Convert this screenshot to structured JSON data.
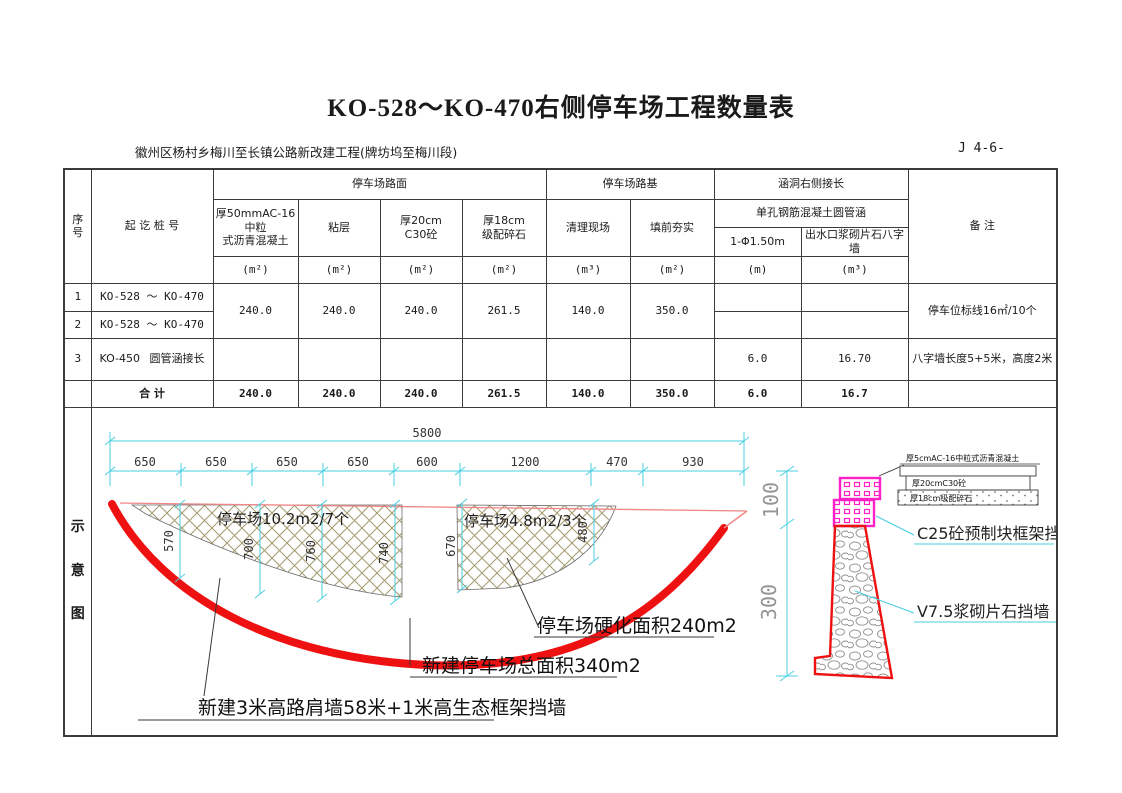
{
  "title": "KO-528～KO-470右侧停车场工程数量表",
  "subtitle": "徽州区杨村乡梅川至长镇公路新改建工程(牌坊坞至梅川段)",
  "sheet_no": "J 4-6-",
  "table": {
    "h_seq": "序号",
    "h_stake": "起    讫    桩    号",
    "h_pavement_group": "停车场路面",
    "h_roadbed_group": "停车场路基",
    "h_culvert_group": "涵洞右侧接长",
    "h_culvert_sub": "单孔钢筋混凝土圆管涵",
    "h_remark": "备    注",
    "h_c1": "厚50mmAC-16中粒\n式沥青混凝土",
    "h_c2": "粘层",
    "h_c3": "厚20cm\nC30砼",
    "h_c4": "厚18cm\n级配碎石",
    "h_c5": "清理现场",
    "h_c6": "填前夯实",
    "h_c7": "1-Φ1.50m",
    "h_c8": "出水口浆砌片石八字墙",
    "u_c1": "(m²)",
    "u_c2": "(m²)",
    "u_c3": "(m²)",
    "u_c4": "(m²)",
    "u_c5": "(m³)",
    "u_c6": "(m²)",
    "u_c7": "(m)",
    "u_c8": "(m³)",
    "rows": {
      "r1_seq": "1",
      "r1_stake": "KO-528    ～    KO-470",
      "r2_seq": "2",
      "r2_stake": "KO-528    ～    KO-470",
      "r3_seq": "3",
      "r3_stake_l": "KO-450",
      "r3_stake_r": "圆管涵接长",
      "v1": "240.0",
      "v2": "240.0",
      "v3": "240.0",
      "v4": "261.5",
      "v5": "140.0",
      "v6": "350.0",
      "remark12": "停车位标线16㎡/10个",
      "r3_v7": "6.0",
      "r3_v8": "16.70",
      "remark3": "八字墙长度5+5米，高度2米"
    },
    "total": {
      "label": "合    计",
      "v1": "240.0",
      "v2": "240.0",
      "v3": "240.0",
      "v4": "261.5",
      "v5": "140.0",
      "v6": "350.0",
      "v7": "6.0",
      "v8": "16.7"
    }
  },
  "diagram": {
    "side_chars": [
      "示",
      "意",
      "图"
    ],
    "dim_total": "5800",
    "segs": [
      "650",
      "650",
      "650",
      "650",
      "600",
      "1200",
      "470",
      "930"
    ],
    "vdims": [
      "570",
      "700",
      "760",
      "740",
      "670",
      "480"
    ],
    "hatch1_label": "停车场10.2m2/7个",
    "hatch2_label": "停车场4.8m2/3个",
    "ann_hardened": "停车场硬化面积240m2",
    "ann_total_area": "新建停车场总面积340m2",
    "ann_wall": "新建3米高路肩墙58米+1米高生态框架挡墙",
    "section": {
      "dim_upper": "100",
      "dim_lower": "300",
      "layer1": "厚5cmAC-16中粒式沥青混凝土",
      "layer2": "厚20cmC30砼",
      "layer3": "厚18cm级配碎石",
      "label_c25": "C25砼预制块框架挡墙",
      "label_v75": "V7.5浆砌片石挡墙"
    }
  },
  "colors": {
    "dim_cyan": "#49cfe2",
    "thick_red": "#ee1111",
    "thin_red": "#f08686",
    "magenta": "#ff20c8",
    "hatch_tan": "#a39a6e"
  }
}
